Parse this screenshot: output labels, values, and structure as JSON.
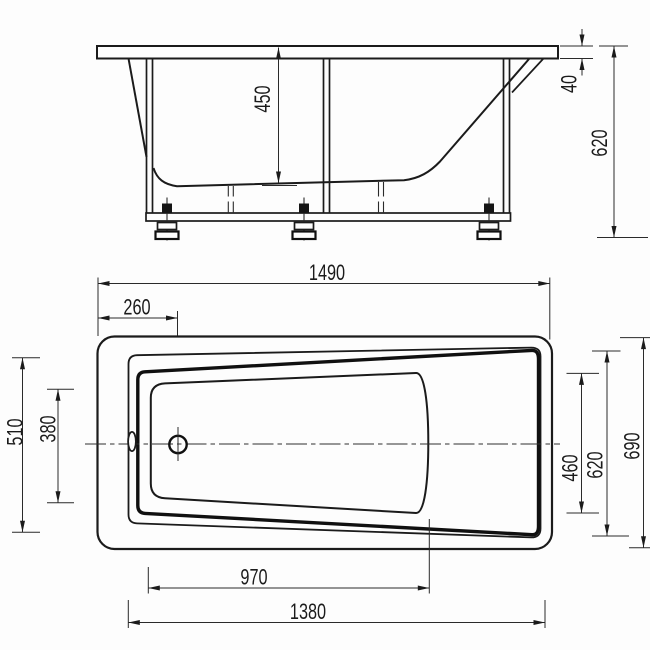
{
  "drawing": {
    "kind": "two-view dimensioned technical drawing of a rectangular bathtub on an adjustable-feet frame",
    "colors": {
      "line": "#1b1b1b",
      "background": "#fdfdfd"
    }
  },
  "side_view": {
    "dims": {
      "interior_depth": "450",
      "rim_height": "40",
      "overall_height": "620"
    }
  },
  "plan_view": {
    "dims": {
      "overall_length": "1490",
      "drain_center_offset": "260",
      "head_end_rim_width": "510",
      "head_end_bottom_width": "380",
      "bottom_length": "970",
      "inner_rim_length": "1380",
      "foot_end_bottom_width": "460",
      "foot_end_rim_width": "620",
      "overall_width": "690"
    }
  }
}
